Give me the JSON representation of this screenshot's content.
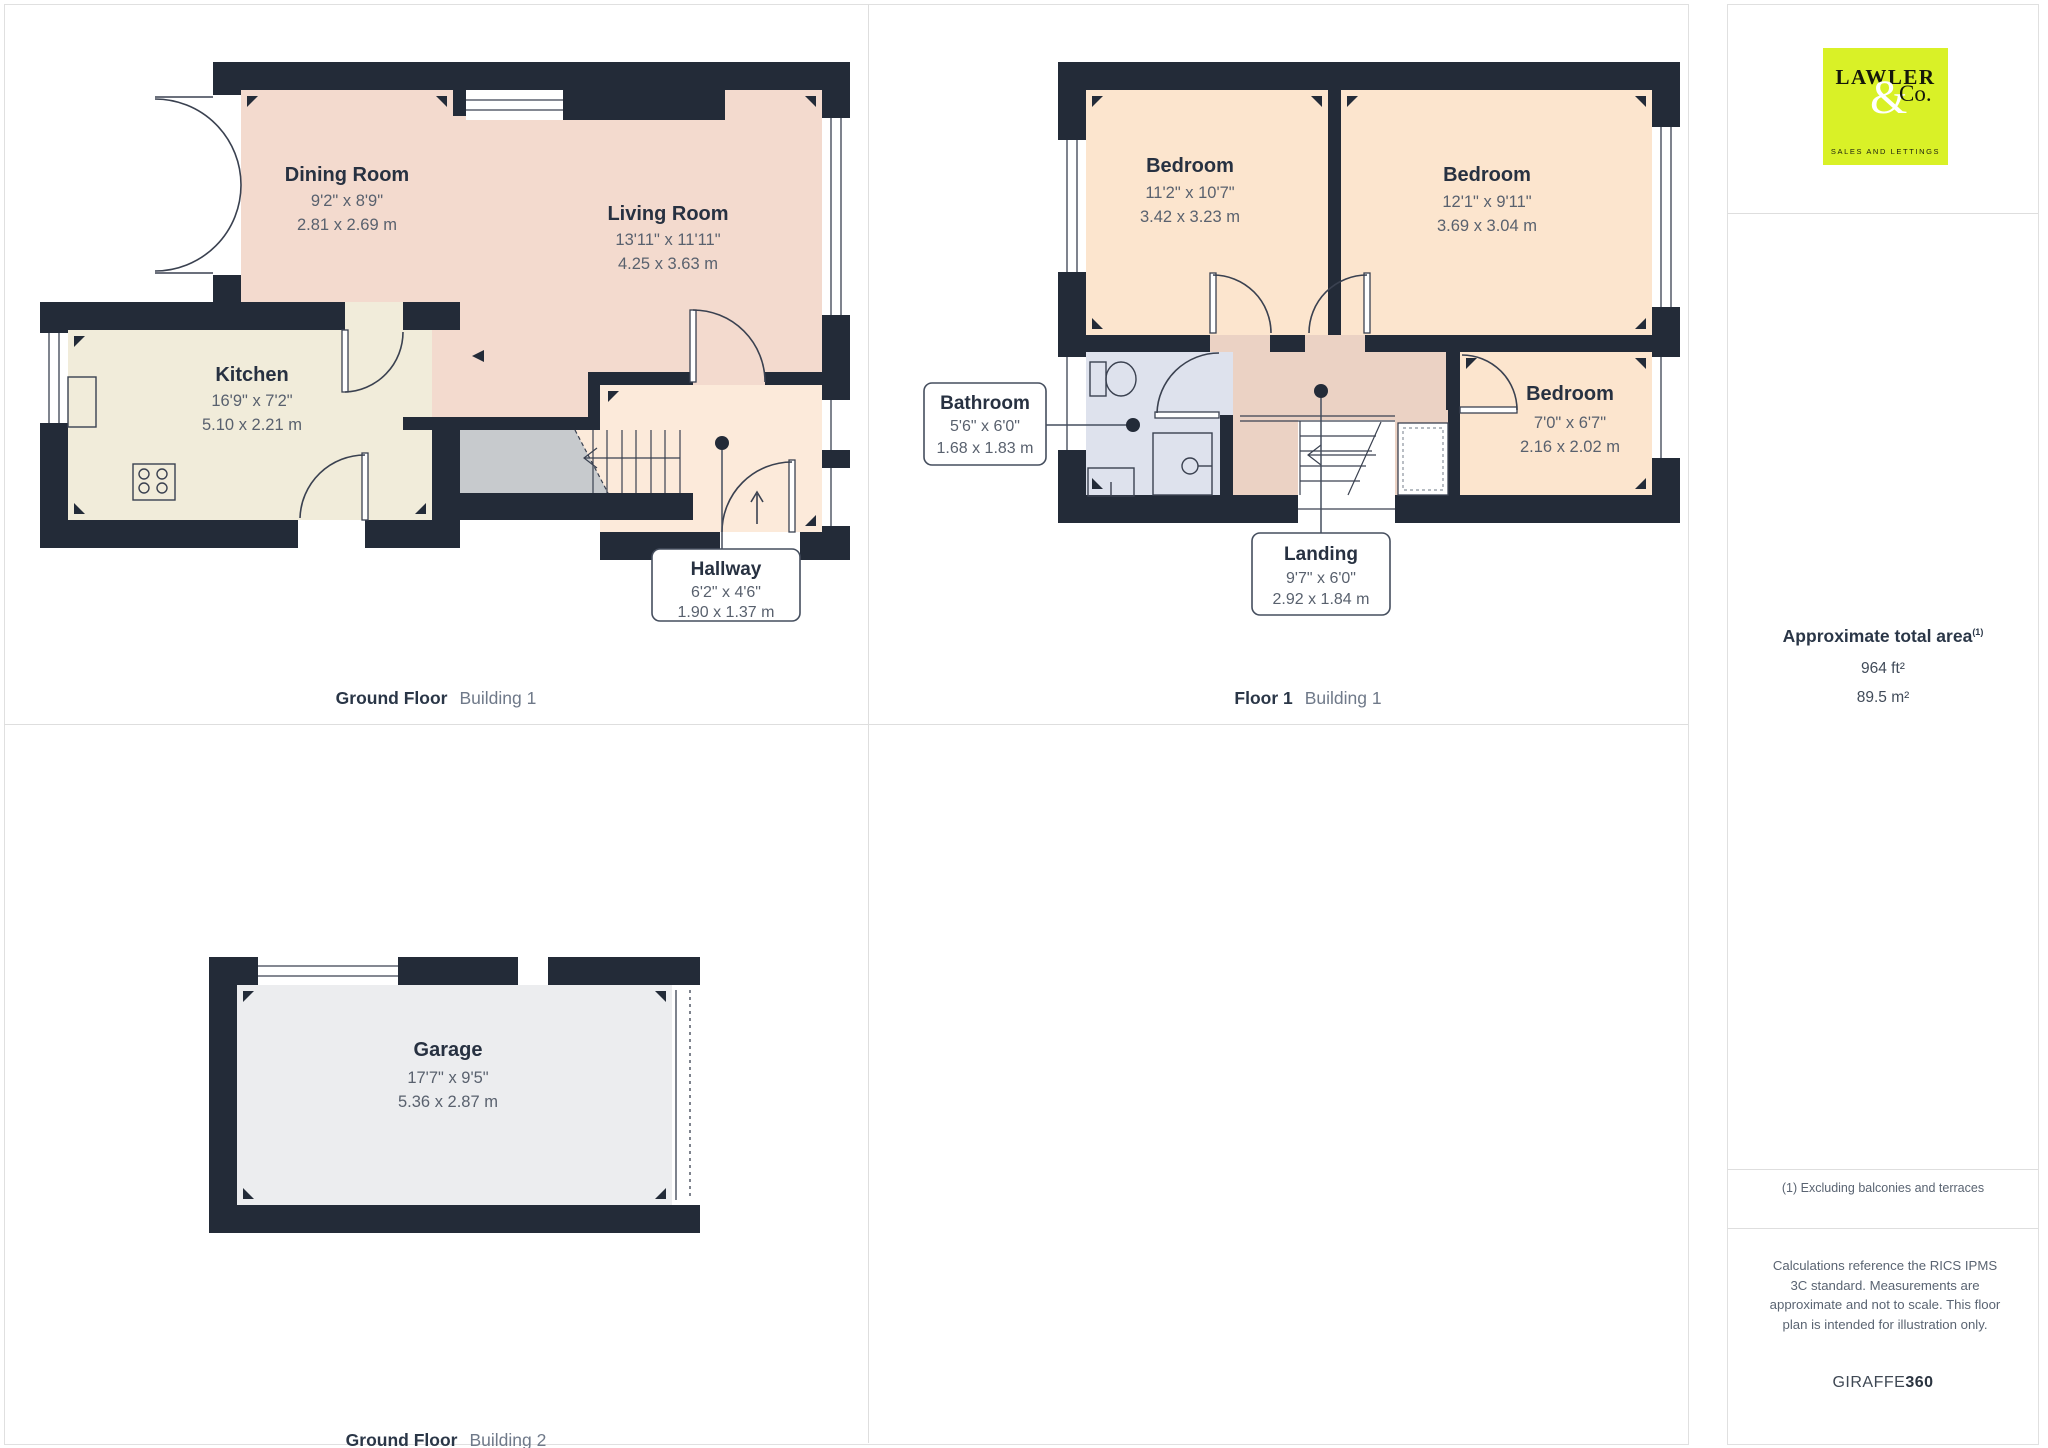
{
  "plans": {
    "g1": {
      "caption_bold": "Ground Floor",
      "caption_light": "Building 1",
      "rooms": [
        {
          "name": "Dining Room",
          "imperial": "9'2\" x 8'9\"",
          "metric": "2.81 x 2.69 m"
        },
        {
          "name": "Living Room",
          "imperial": "13'11\" x 11'11\"",
          "metric": "4.25 x 3.63 m"
        },
        {
          "name": "Kitchen",
          "imperial": "16'9\" x 7'2\"",
          "metric": "5.10 x 2.21 m"
        },
        {
          "name": "Hallway",
          "imperial": "6'2\" x 4'6\"",
          "metric": "1.90 x 1.37 m"
        }
      ]
    },
    "f1": {
      "caption_bold": "Floor 1",
      "caption_light": "Building 1",
      "rooms": [
        {
          "name": "Bedroom",
          "imperial": "11'2\" x 10'7\"",
          "metric": "3.42 x 3.23 m"
        },
        {
          "name": "Bedroom",
          "imperial": "12'1\" x 9'11\"",
          "metric": "3.69 x 3.04 m"
        },
        {
          "name": "Bathroom",
          "imperial": "5'6\" x 6'0\"",
          "metric": "1.68 x 1.83 m"
        },
        {
          "name": "Bedroom",
          "imperial": "7'0\" x 6'7\"",
          "metric": "2.16 x 2.02 m"
        },
        {
          "name": "Landing",
          "imperial": "9'7\" x 6'0\"",
          "metric": "2.92 x 1.84 m"
        }
      ]
    },
    "g2": {
      "caption_bold": "Ground Floor",
      "caption_light": "Building 2",
      "rooms": [
        {
          "name": "Garage",
          "imperial": "17'7\" x 9'5\"",
          "metric": "5.36 x 2.87 m"
        }
      ]
    }
  },
  "sidebar": {
    "logo": {
      "name": "LAWLER",
      "amp": "&",
      "co": "Co.",
      "tagline": "SALES AND LETTINGS",
      "bg": "#d9f127"
    },
    "area": {
      "title": "Approximate total area",
      "superscript": "(1)",
      "imperial": "964 ft²",
      "metric": "89.5 m²"
    },
    "footnote": "(1) Excluding balconies and terraces",
    "disclaimer": "Calculations reference the RICS IPMS 3C standard. Measurements are approximate and not to scale. This floor plan is intended for illustration only.",
    "brand_light": "GIRAFFE",
    "brand_bold": "360"
  },
  "colors": {
    "wall": "#232b38",
    "living_pink": "#f3dace",
    "bedroom_peach": "#fce5ce",
    "hall_peach": "#fceada",
    "kitchen_beige": "#f1ecda",
    "understairs_gray": "#c7cacd",
    "bathroom_blue": "#dee2ed",
    "landing_tan": "#ebd2c4",
    "garage_gray": "#ecedef",
    "logo_lime": "#d9f127",
    "label_dark": "#273141",
    "dim_gray": "#59616e"
  }
}
